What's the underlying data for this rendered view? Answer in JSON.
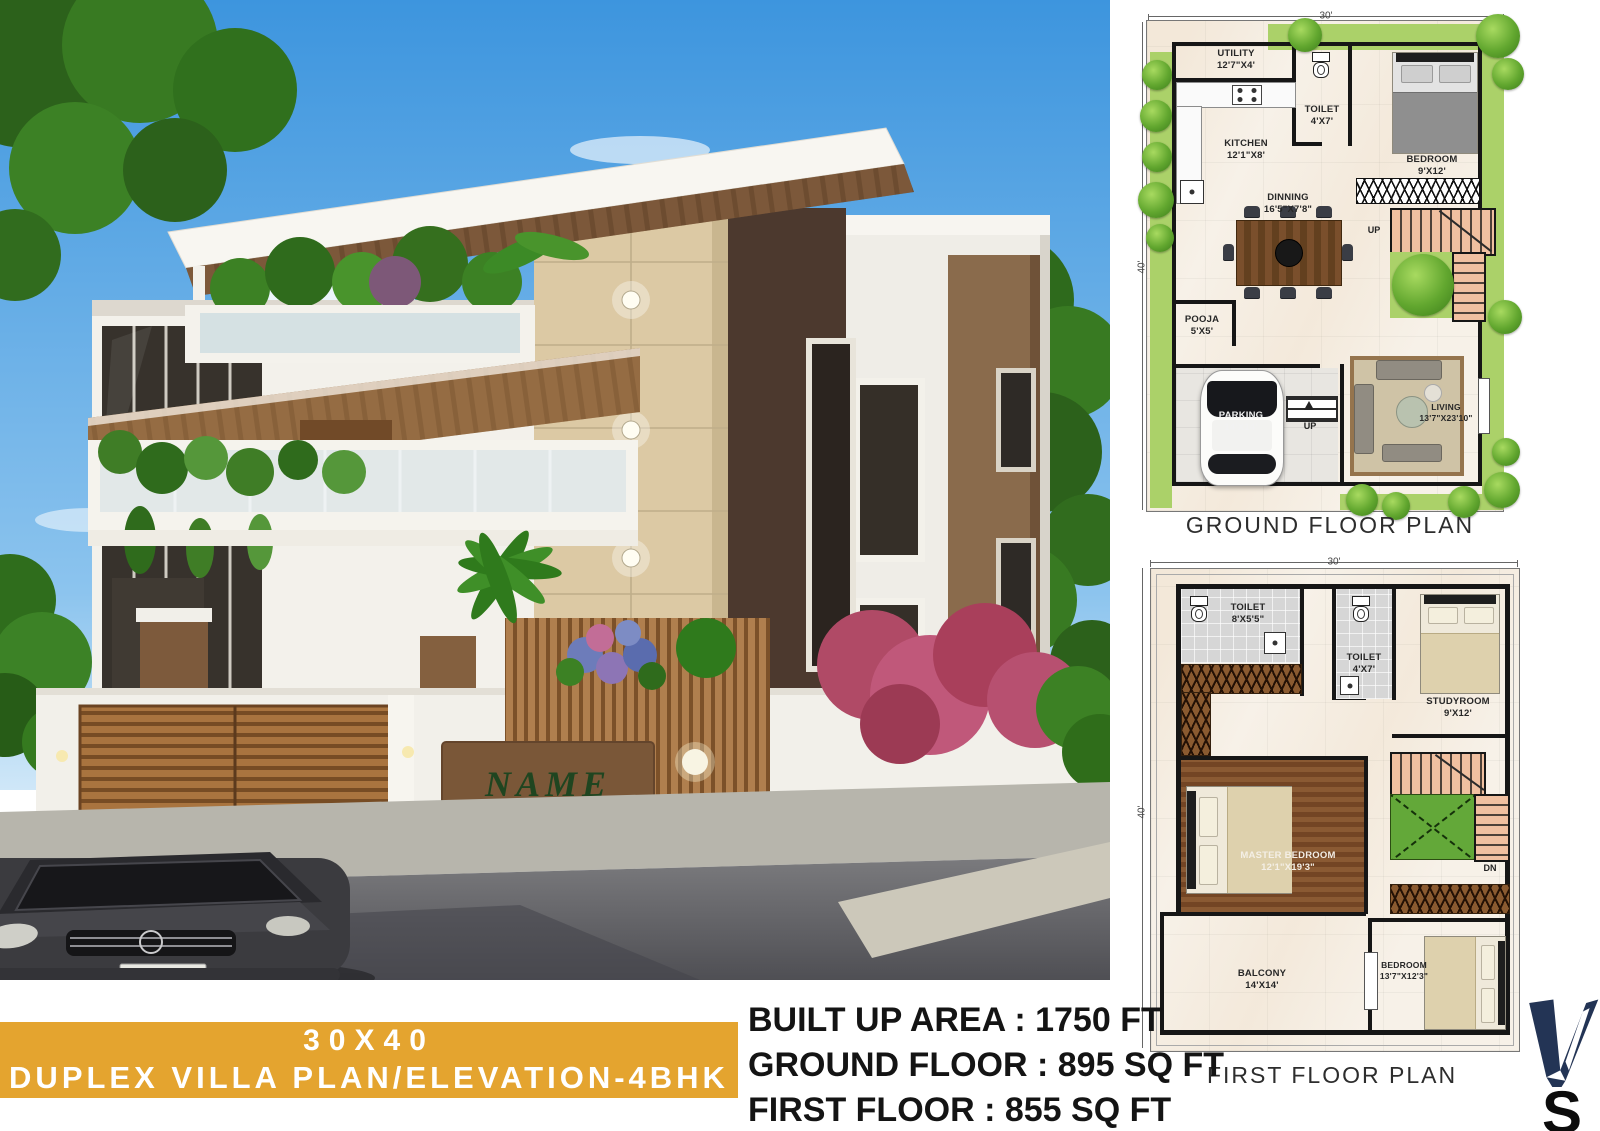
{
  "banner": {
    "line1": "30X40",
    "line2": "DUPLEX VILLA PLAN/ELEVATION-4BHK",
    "bg_color": "#E4A42F",
    "text_color": "#FFFFFF"
  },
  "specs": {
    "built_up": "BUILT UP AREA : 1750 FT",
    "ground": "GROUND FLOOR : 895 SQ FT",
    "first": "FIRST FLOOR : 855 SQ FT"
  },
  "logo": {
    "letter": "S",
    "mark_color": "#233455"
  },
  "elevation": {
    "name_sign": "NAME"
  },
  "gfp": {
    "title": "GROUND FLOOR PLAN",
    "dim_width": "30'",
    "dim_height": "40'",
    "stair_up": "UP",
    "entry_up": "UP",
    "rooms": [
      {
        "name": "UTILITY",
        "size": "12'7\"X4'"
      },
      {
        "name": "KITCHEN",
        "size": "12'1\"X8'"
      },
      {
        "name": "TOILET",
        "size": "4'X7'"
      },
      {
        "name": "BEDROOM",
        "size": "9'X12'"
      },
      {
        "name": "DINNING",
        "size": "16'5\"X7'8\""
      },
      {
        "name": "POOJA",
        "size": "5'X5'"
      },
      {
        "name": "PARKING",
        "size": "14'X14'"
      },
      {
        "name": "LIVING",
        "size": "13'7\"X23'10\""
      }
    ]
  },
  "ffp": {
    "title": "FIRST FLOOR PLAN",
    "dim_width": "30'",
    "dim_height": "40'",
    "stair_dn": "DN",
    "rooms": [
      {
        "name": "TOILET",
        "size": "8'X5'5\""
      },
      {
        "name": "TOILET",
        "size": "4'X7'"
      },
      {
        "name": "STUDYROOM",
        "size": "9'X12'"
      },
      {
        "name": "MASTER BEDROOM",
        "size": "12'1\"X19'3\""
      },
      {
        "name": "BALCONY",
        "size": "14'X14'"
      },
      {
        "name": "BEDROOM",
        "size": "13'7\"X12'3\""
      }
    ]
  }
}
